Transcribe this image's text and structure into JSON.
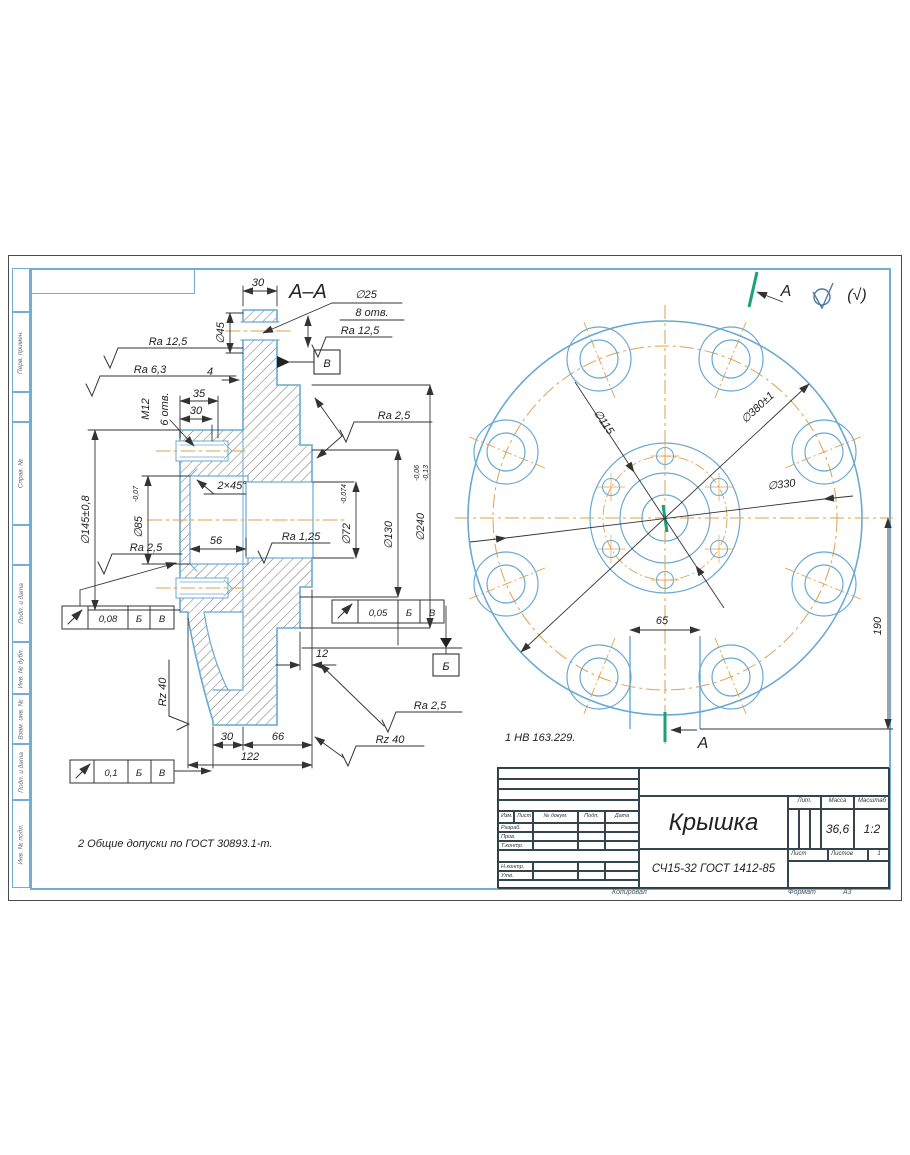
{
  "frame": {
    "side_labels": [
      "Перв. примен.",
      "Справ. №",
      "Подп. и дата",
      "Инв. № дубл.",
      "Взам. инв. №",
      "Подп. и дата",
      "Инв. № подл."
    ],
    "footer": {
      "copied": "Копировал",
      "format_label": "Формат",
      "format_value": "А3"
    }
  },
  "corner_mark": {
    "paren": "(√)"
  },
  "section": {
    "title": "А–А",
    "labels": {
      "dim30_top": "30",
      "dia45": "∅45",
      "dim4": "4",
      "dim35": "35",
      "dim30_thread": "30",
      "m12": "М12",
      "m12_qty": "6 отв.",
      "dia145": "∅145±0,8",
      "dia85": "∅85",
      "dia85_tol": "-0,07",
      "chamfer": "2×45°",
      "dim56": "56",
      "dia72": "∅72",
      "dia72_tol": "-0,074",
      "dia130": "∅130",
      "dia240": "∅240",
      "dia240_tol_hi": "-0,06",
      "dia240_tol_lo": "-0,13",
      "dim12": "12",
      "dim30_bot": "30",
      "dim66": "66",
      "dim122": "122",
      "hole_dia": "∅25",
      "hole_qty": "8 отв."
    },
    "roughness": {
      "ra125_left": "Ra 12,5",
      "ra63": "Ra 6,3",
      "ra125_holes": "Ra 12,5",
      "ra25_right": "Ra 2,5",
      "ra25_left": "Ra 2,5",
      "ra125_bore": "Ra 1,25",
      "rz40_skirt": "Rz 40",
      "ra25_bottom": "Ra 2,5",
      "rz40_bottom": "Rz 40"
    },
    "datums": {
      "b": "Б",
      "v": "В"
    },
    "tol_frames": [
      {
        "value": "0,08",
        "d1": "Б",
        "d2": "В"
      },
      {
        "value": "0,05",
        "d1": "Б",
        "d2": "В"
      },
      {
        "value": "0,1",
        "d1": "Б",
        "d2": "В"
      }
    ]
  },
  "front": {
    "section_letter": "А",
    "dia115": "∅115",
    "dia380": "∅380±1",
    "dia330": "∅330",
    "dim65": "65",
    "dim190": "190"
  },
  "notes": {
    "n1": "1 НВ 163.229.",
    "n2": "2 Общие допуски по ГОСТ 30893.1-m."
  },
  "title_block": {
    "part_name": "Крышка",
    "material": "СЧ15-32 ГОСТ 1412-85",
    "cols": {
      "izm": "Изм.",
      "list": "Лист",
      "doc": "№ докум.",
      "podp": "Подп.",
      "data": "Дата"
    },
    "rows": {
      "razrab": "Разраб.",
      "prov": "Пров.",
      "tkontr": "Т.контр.",
      "nkontr": "Н.контр.",
      "utv": "Утв."
    },
    "right": {
      "lit": "Лит.",
      "mass_label": "Масса",
      "mass": "36,6",
      "scale_label": "Масштаб",
      "scale": "1:2",
      "sheet_label": "Лист",
      "sheets_label": "Листов",
      "sheets": "1"
    }
  }
}
